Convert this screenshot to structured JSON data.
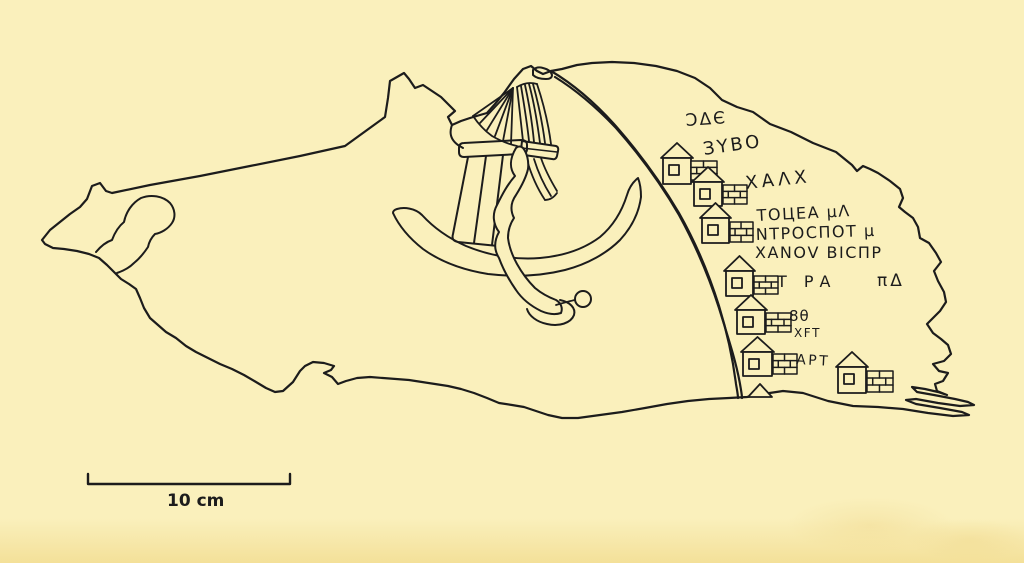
{
  "canvas": {
    "width": 1024,
    "height": 563,
    "background": "#faf0bc",
    "ink": "#1c1c1c"
  },
  "figure": {
    "description": "Hand-drawn line illustration of an inscribed map-stone fragment: central boat/tent motif, a curved double-line road with house pictograms and brick blocks, Greek-style inscriptions",
    "inscriptions": [
      {
        "text": "ƆΔЄ",
        "x": 686,
        "y": 126,
        "size": 17,
        "rot": -4,
        "ls": 2
      },
      {
        "text": "ЗΥΒΟ",
        "x": 704,
        "y": 155,
        "size": 18,
        "rot": -8,
        "ls": 2.5
      },
      {
        "text": "ΧΑΛΧ",
        "x": 746,
        "y": 189,
        "size": 18,
        "rot": -6,
        "ls": 4
      },
      {
        "text": "ΤΟЦΕΑ μΛ",
        "x": 757,
        "y": 221,
        "size": 16,
        "rot": -3,
        "ls": 1.5
      },
      {
        "text": "ΝΤΡΟCΠΟΤ μ",
        "x": 756,
        "y": 240,
        "size": 16,
        "rot": -2,
        "ls": 1.5
      },
      {
        "text": "ΧΑΝΟV ΒΙCΠΡ",
        "x": 755,
        "y": 258,
        "size": 16,
        "rot": 0,
        "ls": 1.5
      },
      {
        "text": "Τ ΡΑ",
        "x": 777,
        "y": 287,
        "size": 16,
        "rot": 0,
        "ls": 6
      },
      {
        "text": "πΔ",
        "x": 877,
        "y": 286,
        "size": 17,
        "rot": 0,
        "ls": 3
      },
      {
        "text": "8θ",
        "x": 789,
        "y": 321,
        "size": 15,
        "rot": 0,
        "ls": 1
      },
      {
        "text": "ΧFΤ",
        "x": 794,
        "y": 337,
        "size": 12,
        "rot": 0,
        "ls": 1.5
      },
      {
        "text": "ΑΡΤ",
        "x": 796,
        "y": 364,
        "size": 14,
        "rot": 3,
        "ls": 2.5
      }
    ],
    "houses": [
      {
        "bx": 663,
        "by": 158,
        "bw": 28,
        "bh": 26,
        "brick": [
          691,
          161,
          26,
          19
        ]
      },
      {
        "bx": 694,
        "by": 182,
        "bw": 28,
        "bh": 24,
        "brick": [
          723,
          185,
          24,
          19
        ]
      },
      {
        "bx": 702,
        "by": 218,
        "bw": 27,
        "bh": 25,
        "brick": [
          730,
          222,
          23,
          20
        ]
      },
      {
        "bx": 726,
        "by": 271,
        "bw": 27,
        "bh": 25,
        "brick": [
          754,
          276,
          24,
          18
        ]
      },
      {
        "bx": 737,
        "by": 310,
        "bw": 28,
        "bh": 24,
        "brick": [
          766,
          313,
          25,
          19
        ]
      },
      {
        "bx": 743,
        "by": 352,
        "bw": 29,
        "bh": 24,
        "brick": [
          773,
          354,
          24,
          20
        ]
      },
      {
        "bx": 838,
        "by": 367,
        "bw": 28,
        "bh": 26,
        "brick": [
          867,
          371,
          26,
          21
        ]
      }
    ],
    "lone_roof": {
      "points": "748,397 760,384 772,397"
    }
  },
  "scale_bar": {
    "label": "10 cm",
    "x1": 88,
    "x2": 290,
    "y": 484,
    "tick_h": 10,
    "label_x": 167,
    "label_y": 506,
    "size": 17
  }
}
